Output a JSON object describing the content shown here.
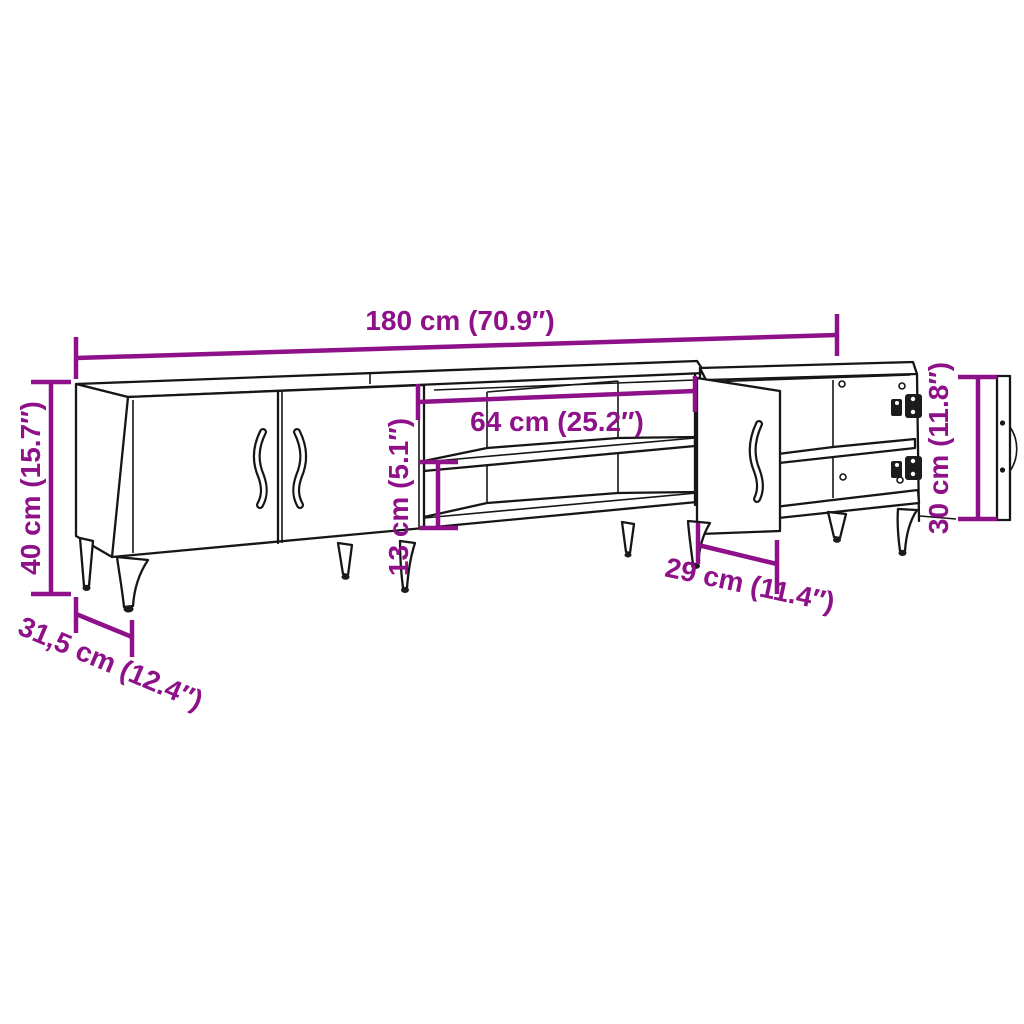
{
  "diagram": {
    "type": "furniture-dimension-diagram",
    "product": "TV stand with cabinets and open shelf",
    "background_color": "#ffffff",
    "outline_color": "#161616",
    "accent_color": "#8E1189",
    "dimensions": {
      "total_width": "180 cm (70.9″)",
      "total_height": "40 cm (15.7″)",
      "depth": "31,5 cm (12.4″)",
      "open_shelf_width": "64 cm (25.2″)",
      "shelf_gap_height": "13 cm (5.1″)",
      "door_width": "29 cm (11.4″)",
      "door_height": "30 cm (11.8″)"
    }
  }
}
